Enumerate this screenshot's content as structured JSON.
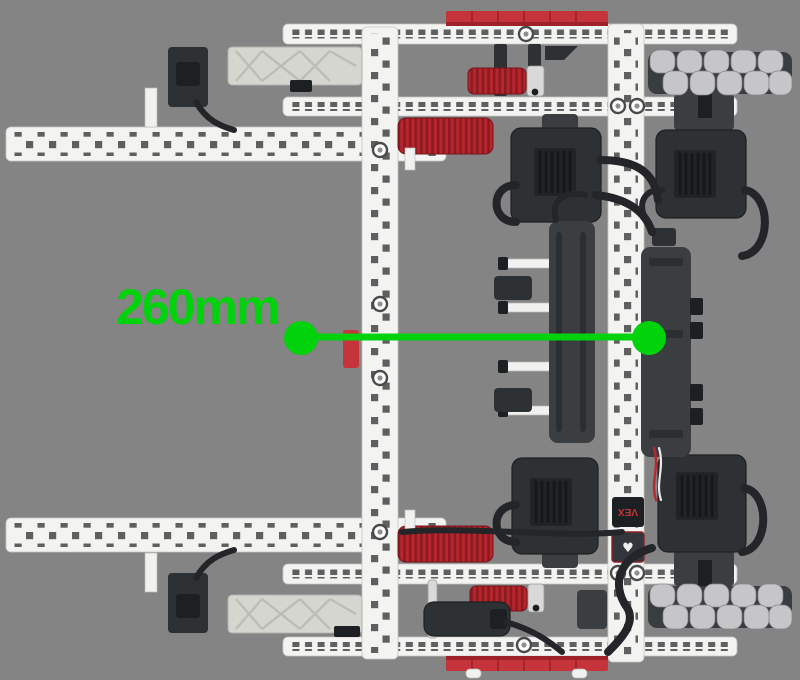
{
  "annotation": {
    "label": "260mm",
    "value_mm": 260
  },
  "robot": {
    "radio_label": "VEX",
    "heart_icon": "♥"
  },
  "colors": {
    "background": "#848484",
    "annotation_green": "#00D20B",
    "beam_white": "#f3f3f1",
    "hole_gray": "#5f5f5f",
    "vex_red": "#c5343b",
    "gear_red_dark": "#8c1b21",
    "gear_red": "#b8262d",
    "part_dark": "#2d3134",
    "part_dark2": "#3a3e41",
    "roller_gray": "#c6c6c8",
    "arm_gray": "#d6d6d1"
  }
}
